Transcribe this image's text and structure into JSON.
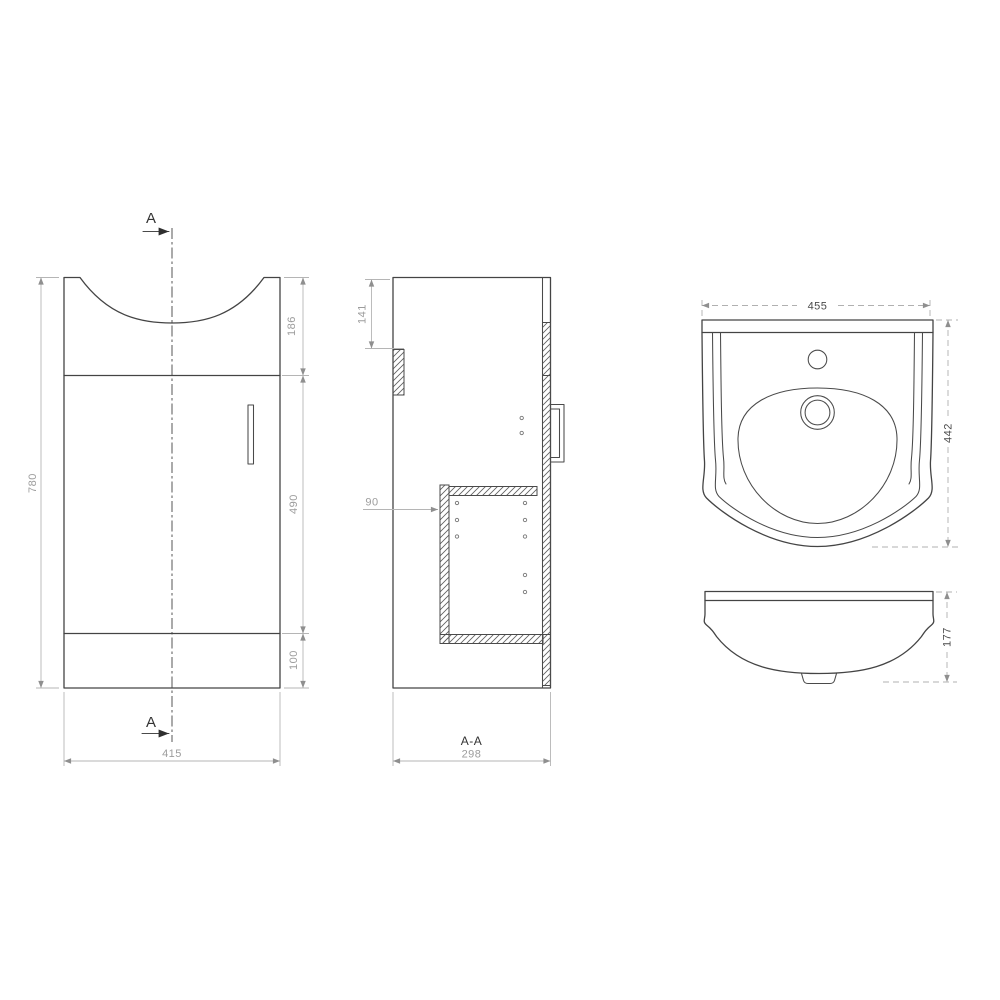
{
  "colors": {
    "background": "#ffffff",
    "drawing_line": "#444444",
    "dimension_line": "#b5b5b5",
    "dimension_text": "#9c9c9c",
    "dark_text": "#333333"
  },
  "front_view": {
    "section_arrow_top": "A",
    "section_arrow_bottom": "A",
    "overall_height_mm": "780",
    "basin_recess_height_mm": "186",
    "door_height_mm": "490",
    "plinth_height_mm": "100",
    "overall_width_mm": "415"
  },
  "section_view": {
    "back_rail_offset_mm": "141",
    "shelf_depth_mm": "90",
    "label": "A-A",
    "depth_mm": "298"
  },
  "basin_top_view": {
    "width_mm": "455",
    "depth_mm": "442"
  },
  "basin_front_view": {
    "height_mm": "177"
  }
}
